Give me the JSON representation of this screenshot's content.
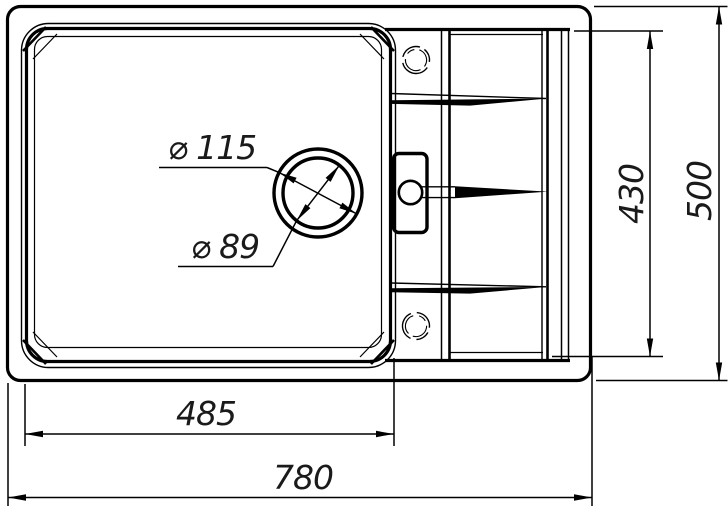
{
  "drawing": {
    "kind": "technical dimension drawing, sink top view",
    "colors": {
      "line": "#000000",
      "background": "#ffffff"
    },
    "labels": {
      "drain_outer_dia": "⌀ 115",
      "drain_inner_dia": "⌀ 89",
      "basin_width": "485",
      "overall_width": "780",
      "inner_depth": "430",
      "overall_depth": "500"
    }
  }
}
